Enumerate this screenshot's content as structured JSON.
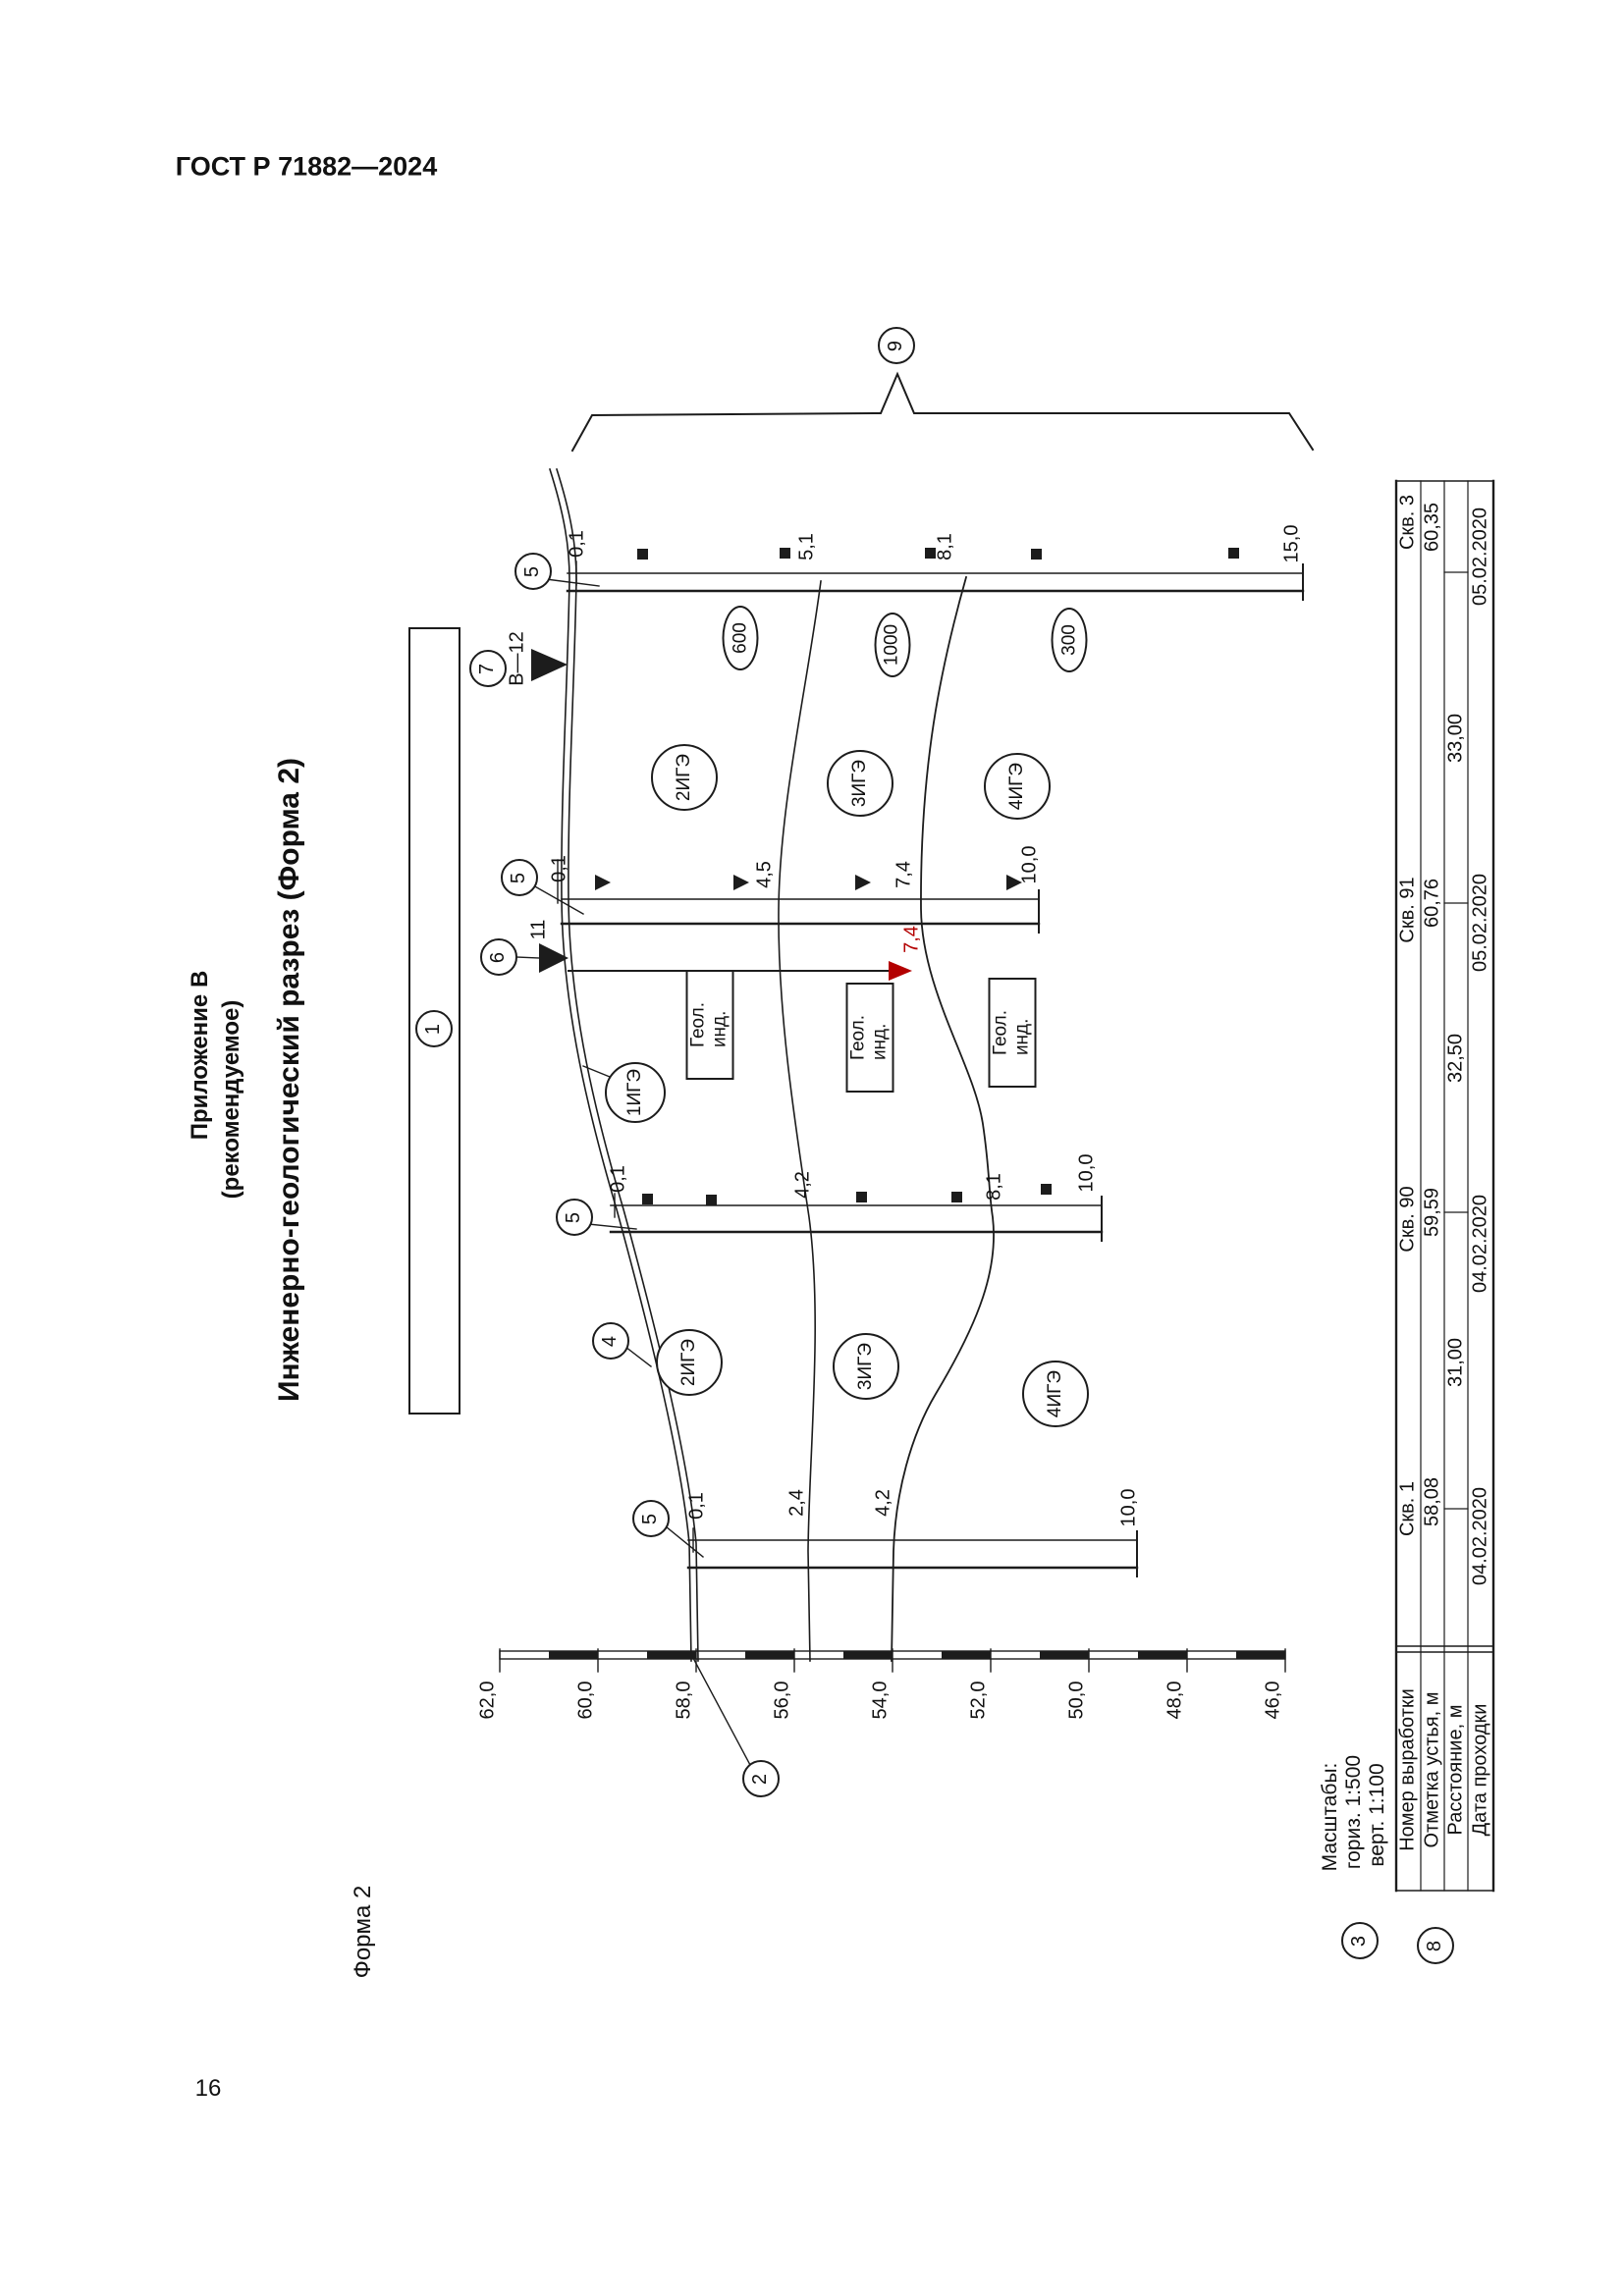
{
  "page": {
    "standard": "ГОСТ Р 71882—2024",
    "number": "16",
    "form_note": "Форма 2"
  },
  "title": {
    "appendix": "Приложение В",
    "appendix_note": "(рекомендуемое)",
    "main": "Инженерно-геологический разрез (Форма 2)"
  },
  "scales": {
    "title": "Масштабы:",
    "horizontal": "гориз. 1:500",
    "vertical": "верт. 1:100"
  },
  "callouts": {
    "1": "1",
    "2": "2",
    "3": "3",
    "4": "4",
    "5": "5",
    "6": "6",
    "7": "7",
    "8": "8",
    "9": "9"
  },
  "markers": {
    "section_ref": "В—12",
    "water_depth": "11",
    "water_depth_red": "7,4"
  },
  "ruler_labels": [
    "62,0",
    "60,0",
    "58,0",
    "56,0",
    "54,0",
    "52,0",
    "50,0",
    "48,0",
    "46,0"
  ],
  "boreholes": [
    {
      "name": "Скв. 3",
      "elevation": "60,35",
      "date": "05.02.2020",
      "depths": [
        "0,1",
        "5,1",
        "8,1",
        "15,0"
      ]
    },
    {
      "name": "Скв. 91",
      "elevation": "60,76",
      "date": "05.02.2020",
      "depths": [
        "0,1",
        "4,5",
        "7,4",
        "10,0"
      ]
    },
    {
      "name": "Скв. 90",
      "elevation": "59,59",
      "date": "04.02.2020",
      "depths": [
        "0,1",
        "4,2",
        "8,1",
        "10,0"
      ]
    },
    {
      "name": "Скв. 1",
      "elevation": "58,08",
      "date": "04.02.2020",
      "depths": [
        "0,1",
        "2,4",
        "4,2",
        "10,0"
      ]
    }
  ],
  "distances": [
    "33,00",
    "32,50",
    "31,00"
  ],
  "table_headers": [
    "Номер выработки",
    "Отметка устья, м",
    "Расстояние, м",
    "Дата проходки"
  ],
  "geology": {
    "pressure_labels": [
      "600",
      "1000",
      "300"
    ],
    "ige_band_top": [
      "2ИГЭ",
      "3ИГЭ",
      "4ИГЭ"
    ],
    "ige_band_bottom": [
      "2ИГЭ",
      "3ИГЭ",
      "4ИГЭ"
    ],
    "ige_surface": "1ИГЭ",
    "geol_index_box": "Геол. инд."
  }
}
